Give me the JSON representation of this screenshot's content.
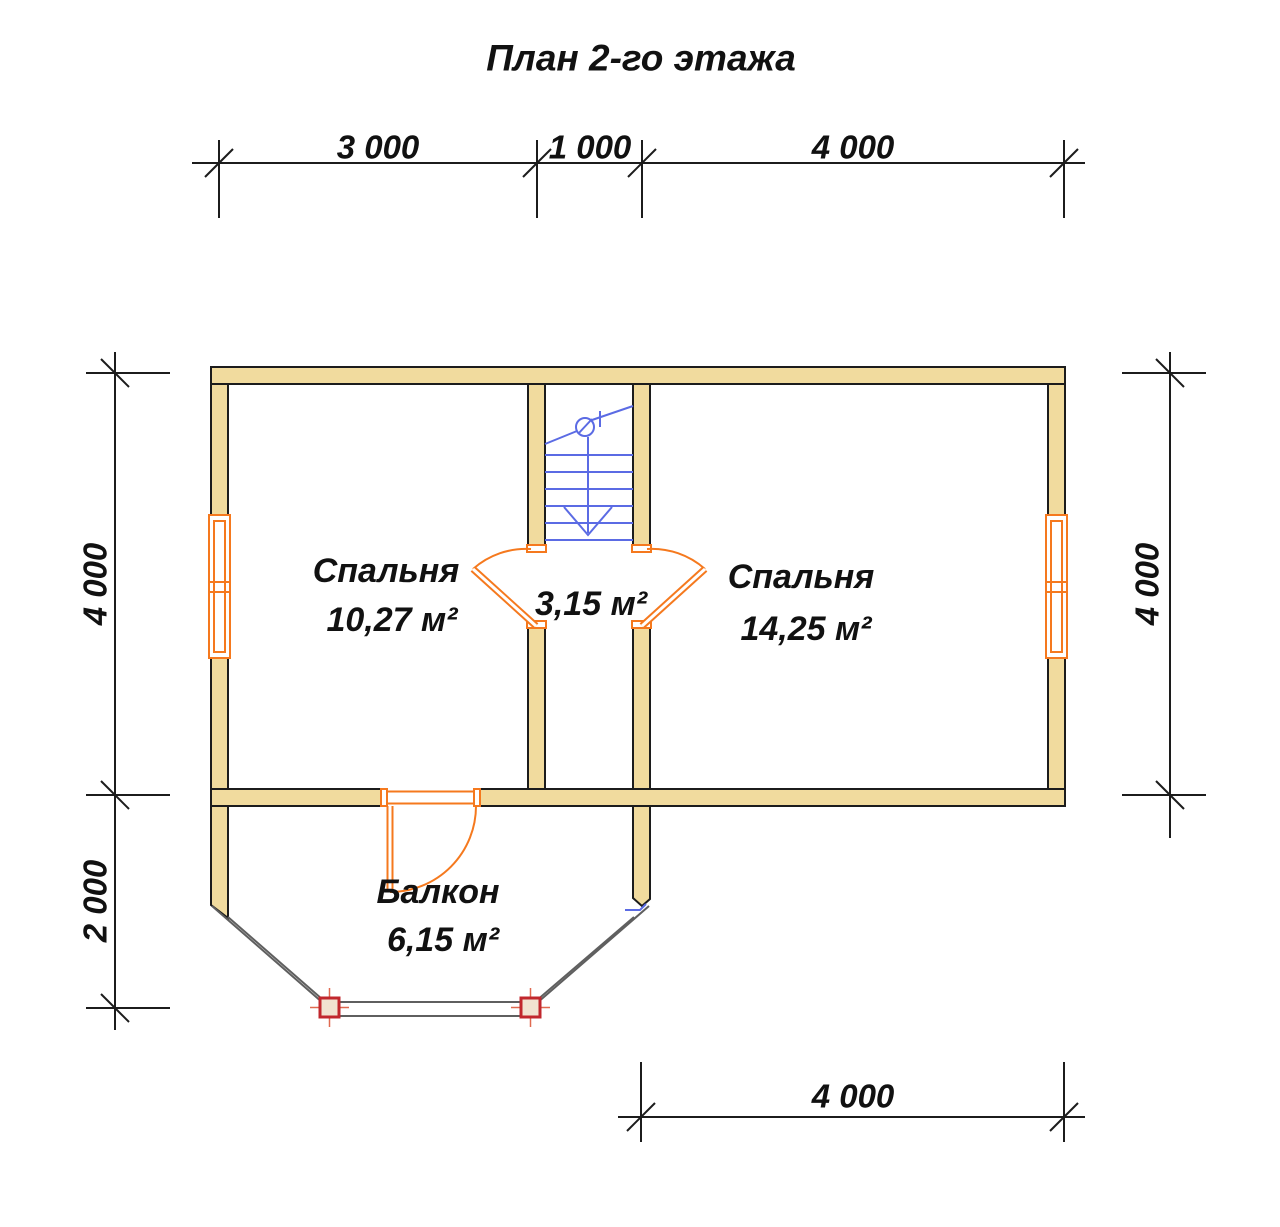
{
  "title": "План 2-го этажа",
  "dims": {
    "top": [
      "3 000",
      "1 000",
      "4 000"
    ],
    "left": [
      "4 000",
      "2 000"
    ],
    "right": [
      "4 000"
    ],
    "bottom": [
      "4 000"
    ]
  },
  "rooms": {
    "bedroom_left": {
      "name": "Спальня",
      "area": "10,27 м²"
    },
    "hall": {
      "area": "3,15 м²"
    },
    "bedroom_right": {
      "name": "Спальня",
      "area": "14,25 м²"
    },
    "balcony": {
      "name": "Балкон",
      "area": "6,15 м²"
    }
  },
  "colors": {
    "wall_fill": "#f1db9e",
    "outline": "#1c1c1c",
    "stairs": "#5b6be4",
    "doors_windows": "#f5791e",
    "railing": "#5f5f5f",
    "post_border": "#c1272d",
    "post_fill": "#f1e2d0",
    "text": "#111111"
  }
}
